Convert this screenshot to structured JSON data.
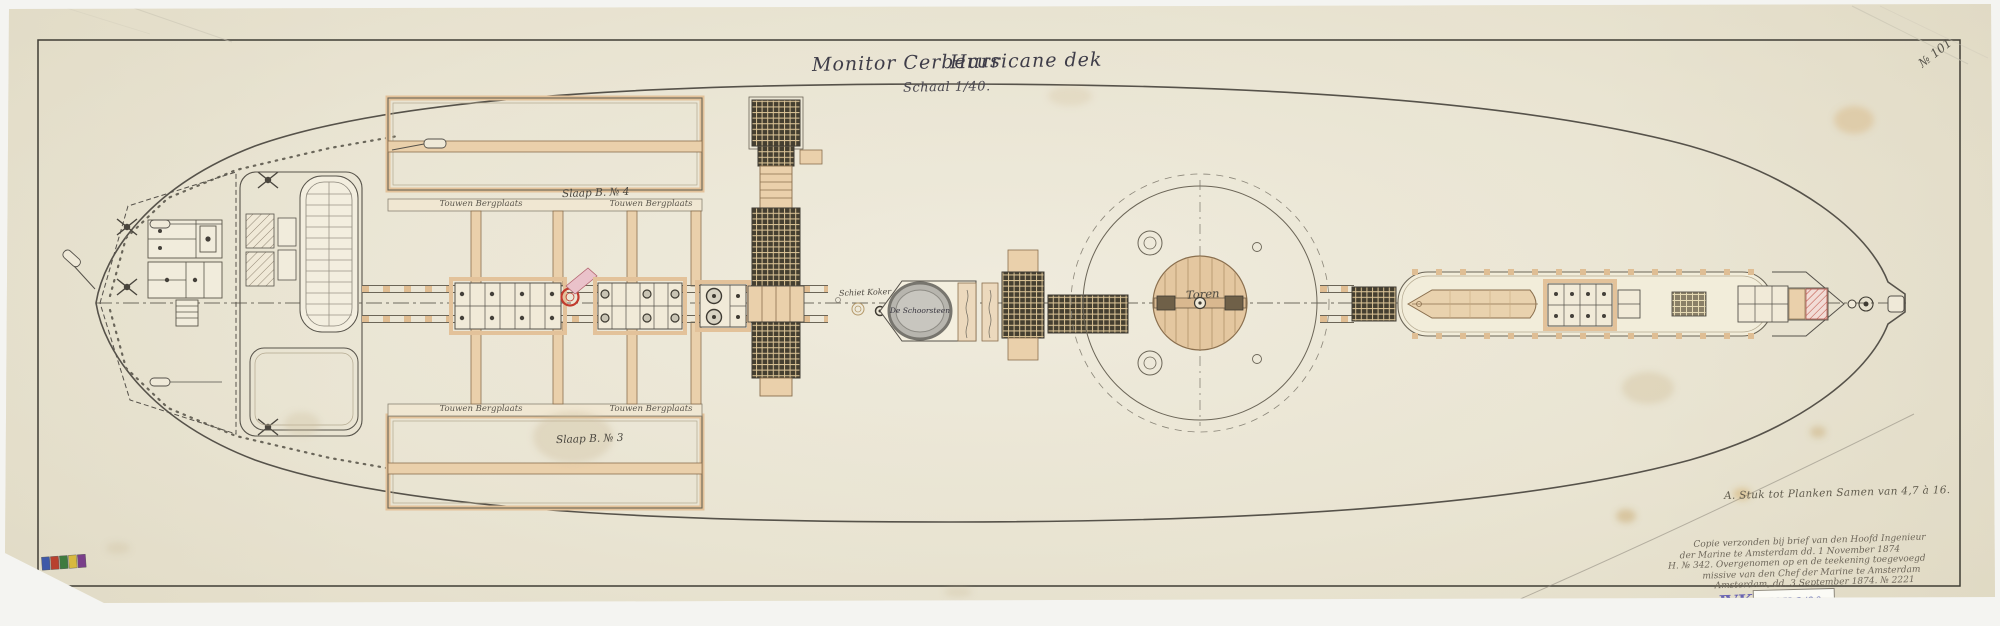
{
  "page": {
    "corner_number": "№ 101"
  },
  "title": {
    "ship": "Monitor Cerberus",
    "sheet": "Hurricane dek",
    "scale": "Schaal 1/40."
  },
  "plan_labels": {
    "sleep_quarters_top": "Slaap B. № 4",
    "sleep_quarters_bottom": "Slaap B. № 3",
    "rope_store": "Touwen Bergplaats",
    "shot_chute": "Schiet Koker",
    "funnel": "De Schoorsteen",
    "turret": "Toren"
  },
  "annotations": {
    "material_note": "A. Stuk tot Planken Samen van 4,7 à 16.",
    "copy_note": [
      "Copie verzonden bij brief van den Hoofd Ingenieur",
      "der Marine te Amsterdam dd. 1 November 1874",
      "H. № 342. Overgenomen op en de teekening toegevoegd",
      "missive van den Chef der Marine te Amsterdam",
      "Amsterdam, dd. 3 September 1874. № 2221"
    ]
  },
  "stamps": {
    "archive_mark": "ⅣK",
    "archive_code": "Ⅳ K 2/90"
  }
}
